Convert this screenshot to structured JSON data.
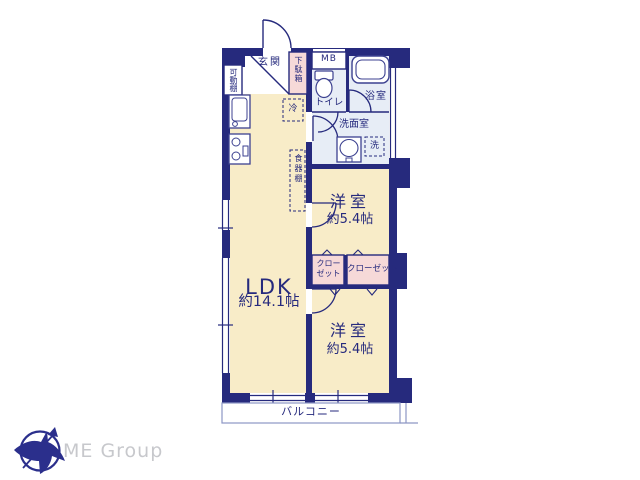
{
  "floor_plan": {
    "entrance_label": "玄関",
    "shoe_box_label": "下駄箱",
    "meter_box_label": "MB",
    "toilet_label": "トイレ",
    "bathroom_label": "浴室",
    "washroom_label": "洗面室",
    "washer_label": "洗",
    "fridge_label": "冷",
    "movable_shelf_label": "可動棚",
    "cupboard_label": "食器棚",
    "ldk": {
      "name": "LDK",
      "size": "約14.1帖"
    },
    "bedroom_upper": {
      "name": "洋室",
      "size": "約5.4帖"
    },
    "bedroom_lower": {
      "name": "洋室",
      "size": "約5.4帖"
    },
    "closet_small_label": "クローゼット",
    "closet_wide_label": "クローゼット",
    "balcony_label": "バルコニー"
  },
  "branding": {
    "company_name": "ME Group"
  },
  "colors": {
    "wall_navy": "#262a7d",
    "room_cream": "#f8ecc8",
    "wet_area_blue": "#e7edf6",
    "closet_pink": "#f6d9d8",
    "balcony_line": "#8d96c4",
    "logo_gray": "#c7c8cc"
  }
}
